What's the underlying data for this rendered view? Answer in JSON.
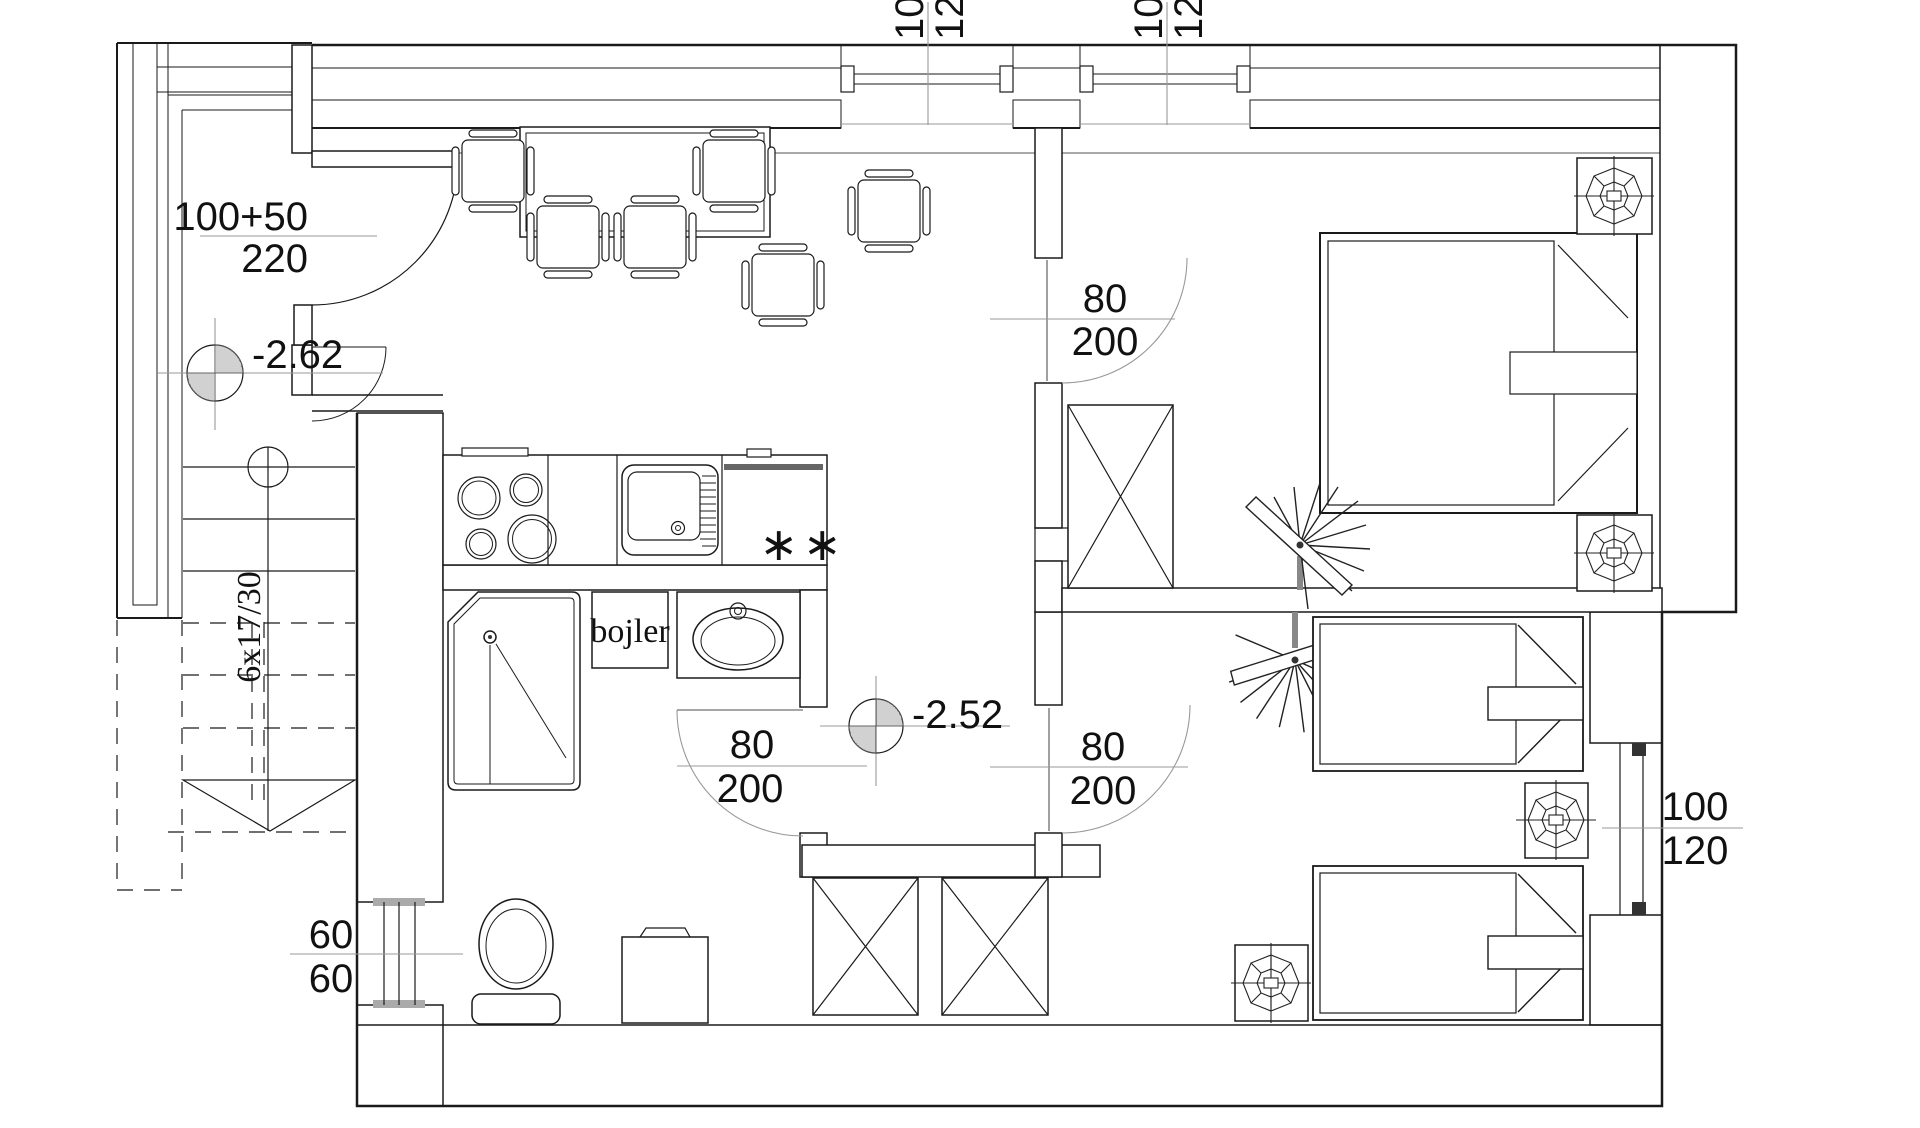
{
  "labels": {
    "entry_door": {
      "w": "100+50",
      "h": "220"
    },
    "level_porch": "-2.62",
    "level_hall": "-2.52",
    "stairs": "6x17/30",
    "boiler": "bojler",
    "fridge_stars": "∗∗",
    "doors": {
      "bathroom": {
        "w": "80",
        "h": "200"
      },
      "bedroom_top": {
        "w": "80",
        "h": "200"
      },
      "bedroom_bottom": {
        "w": "80",
        "h": "200"
      }
    },
    "windows": {
      "top_left": {
        "w": "100",
        "h": "120"
      },
      "top_right": {
        "w": "100",
        "h": "120"
      },
      "right": {
        "w": "100",
        "h": "120"
      },
      "bathroom": {
        "w": "60",
        "h": "60"
      }
    }
  },
  "colors": {
    "line": "#1a1a1a",
    "dim_line": "#999",
    "paper": "#ffffff"
  }
}
